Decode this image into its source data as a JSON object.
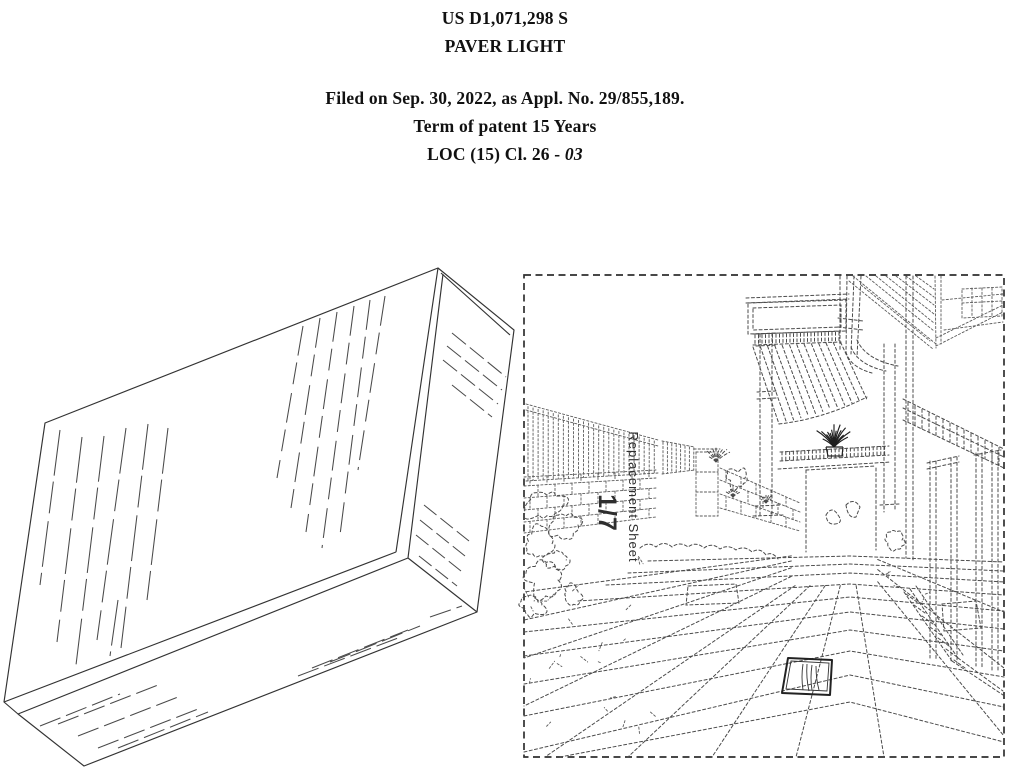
{
  "header": {
    "patent_number": "US D1,071,298 S",
    "doc_title": "PAVER LIGHT",
    "filed_line": "Filed on Sep. 30, 2022, as Appl. No. 29/855,189.",
    "term_line": "Term of patent 15 Years",
    "loc_line": {
      "prefix": "LOC (15) Cl. 26",
      "separator": " - ",
      "value": "03"
    }
  },
  "sheet": {
    "label": "Replacement Sheet",
    "number": "1/7"
  }
}
